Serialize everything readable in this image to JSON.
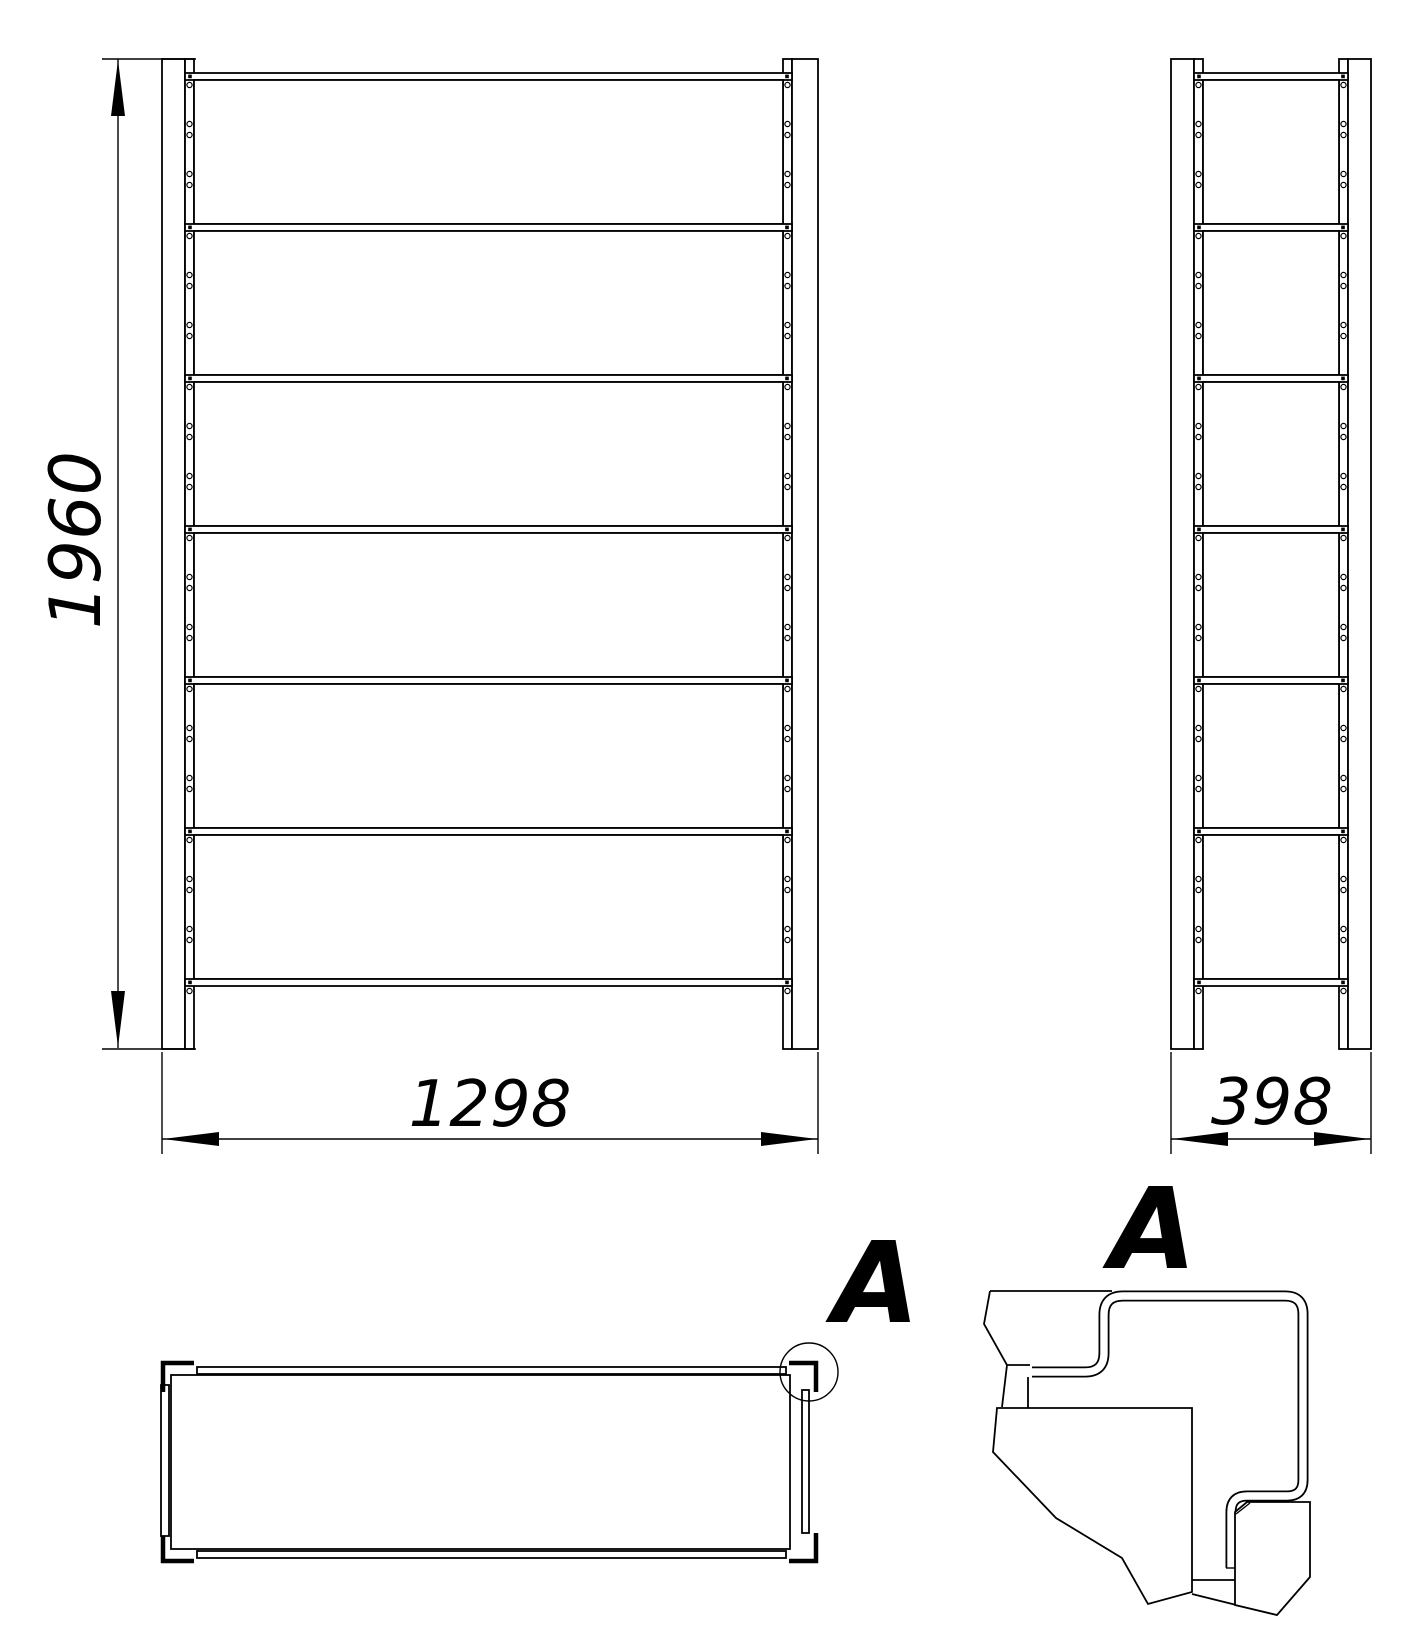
{
  "page": {
    "title": "Shelving rack orthographic drawing",
    "background": "#ffffff",
    "line_color": "#000000"
  },
  "dimensions": {
    "height_mm": "1960",
    "width_mm": "1298",
    "depth_mm": "398"
  },
  "detail_label": "A",
  "structure": {
    "shelf_strips": 7,
    "panel_rows": 6,
    "first_strip_y": 73,
    "strip_spacing": 151,
    "strip_height": 7,
    "hole_single_offset": 12,
    "hole_pair_offsets": [
      51,
      62,
      101,
      112
    ],
    "post_top_y": 59,
    "post_bottom_y": 1049
  }
}
